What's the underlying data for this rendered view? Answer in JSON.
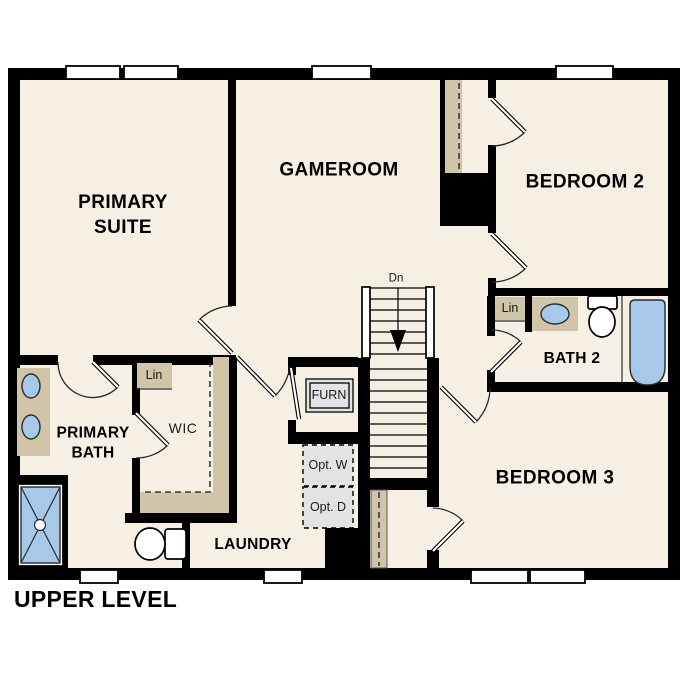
{
  "page": {
    "title": "UPPER LEVEL"
  },
  "colors": {
    "wall": "#000000",
    "floor": "#f6efe3",
    "cabinet": "#d0c4a9",
    "fixture_blue": "#a7c8e9",
    "optional": "#e3e3e3"
  },
  "rooms": {
    "primary_suite": "PRIMARY SUITE",
    "gameroom": "GAMEROOM",
    "bedroom2": "BEDROOM 2",
    "bedroom3": "BEDROOM 3",
    "bath2": "BATH 2",
    "primary_bath": "PRIMARY BATH",
    "wic": "WIC",
    "laundry": "LAUNDRY"
  },
  "annotations": {
    "linen_wic": "Lin",
    "linen_bath2": "Lin",
    "furnace": "FURN",
    "optional_washer": "Opt. W",
    "optional_dryer": "Opt. D",
    "stairs_down": "Dn"
  },
  "fixtures": {
    "primary_bath": [
      "double-vanity-sink",
      "shower",
      "toilet"
    ],
    "bath2": [
      "vanity-sink",
      "toilet",
      "bathtub",
      "linen-closet"
    ],
    "wic": [
      "shelving",
      "linen-closet"
    ],
    "laundry": [
      "optional-washer",
      "optional-dryer"
    ],
    "hall": [
      "furnace-closet",
      "stairs-down"
    ]
  }
}
